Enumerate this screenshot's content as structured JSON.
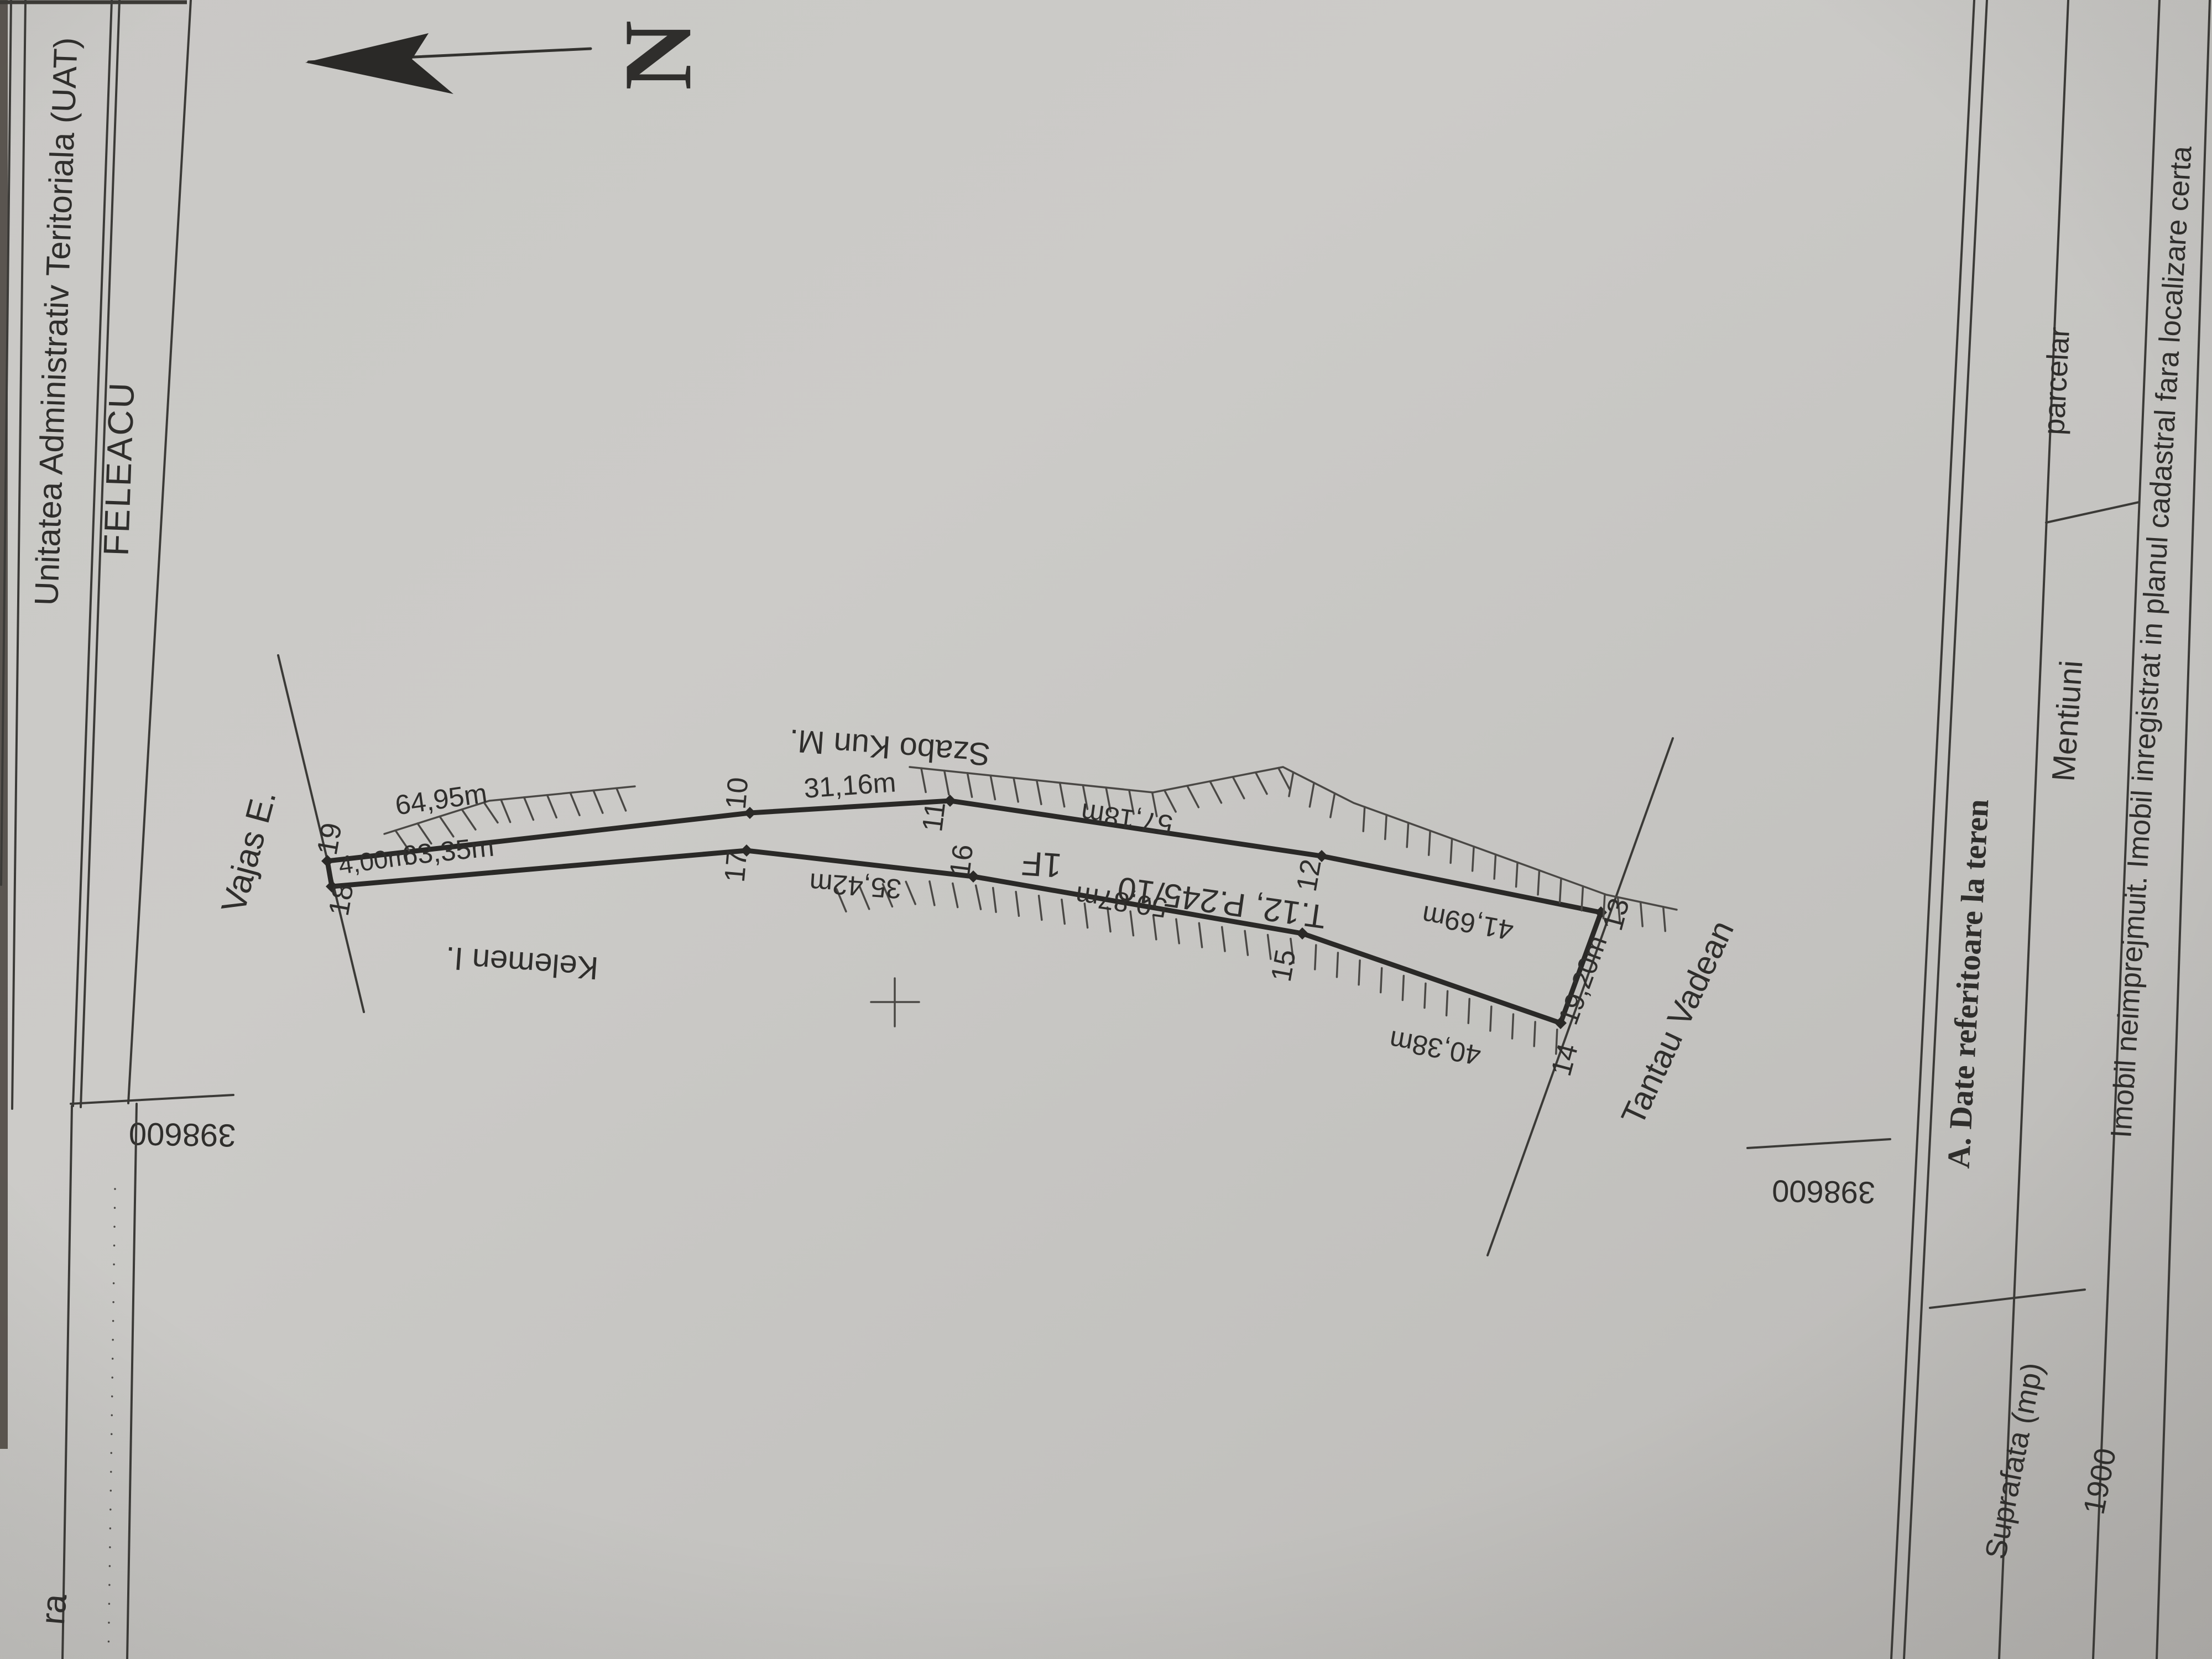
{
  "document": {
    "admin_table": {
      "uat_label": "Unitatea Administrativ Teritoriala (UAT)",
      "uat_value": "FELEACU"
    },
    "north_label": "N",
    "grid_labels": {
      "left": "398600",
      "right": "398600"
    },
    "edge_fragment": "ra",
    "plan": {
      "parcel_id": "T.12, P.245/10",
      "category": "1F",
      "points": [
        "19",
        "18",
        "10",
        "17",
        "11",
        "16",
        "12",
        "15",
        "13",
        "14"
      ],
      "measurements": {
        "seg_19_10": "64,95m",
        "seg_18_17": "63,35m",
        "seg_18_19": "4,00m",
        "seg_10_11": "31,16m",
        "seg_11_12": "57,18m",
        "seg_17_16": "35,42m",
        "seg_16_15": "50,87m",
        "seg_12_13": "41,69m",
        "seg_15_14": "40,38m",
        "seg_13_14": "19,20m"
      },
      "neighbors": {
        "north": "Szabo Kun M.",
        "south": "Kelemen I.",
        "west": "Vajas E.",
        "southeast": "Tantau Vadean"
      }
    },
    "data_table": {
      "title": "A. Date referitoare la teren",
      "col_mentiuni": "Mentiuni",
      "col_parcelar": "parcelar",
      "col_suprafata": "Suprafata (mp)",
      "suprafata_value": "1900",
      "mentiuni_value": "Imobil neimprejmuit. Imobil inregistrat in planul cadastral fara localizare certa"
    }
  }
}
